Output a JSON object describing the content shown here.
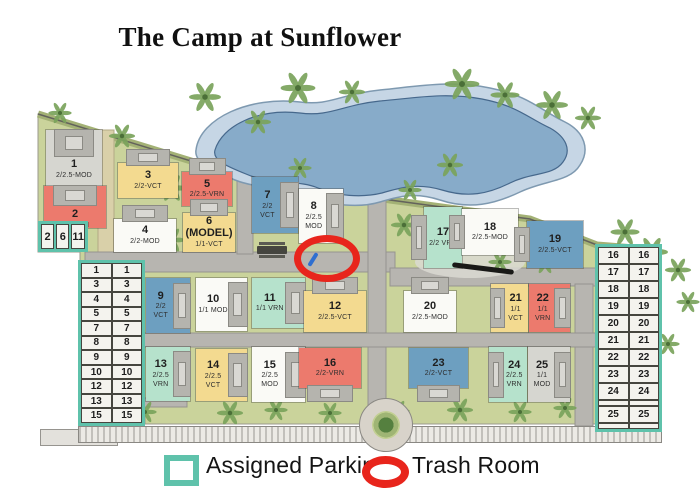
{
  "title": "The Camp at Sunflower",
  "legend": {
    "assigned_parking": "Assigned Parking",
    "trash_room": "Trash Room"
  },
  "colors": {
    "parking_teal": "#5fc2ab",
    "trash_red": "#e8251c",
    "pond": "#87abc9",
    "pond_rim": "#c6d6e5",
    "grass": "#cad39b",
    "road": "#b7b5b0",
    "building": "#b5b4ae",
    "palm": "#79a35b",
    "unit_gray": "#d6d6d0",
    "unit_red": "#ec7a6d",
    "unit_yellow": "#f3da90",
    "unit_mint": "#b6e2cc",
    "unit_blue": "#6d9fc0",
    "unit_white": "#fafaf6"
  },
  "units": [
    {
      "number": "1",
      "type": "2/2.5-MOD",
      "color": "gray"
    },
    {
      "number": "2",
      "type": "1/1-VRN",
      "color": "red"
    },
    {
      "number": "3",
      "type": "2/2-VCT",
      "color": "yellow"
    },
    {
      "number": "4",
      "type": "2/2-MOD",
      "color": "white"
    },
    {
      "number": "5",
      "type": "2/2.5-VRN",
      "color": "red"
    },
    {
      "number": "6",
      "model_tag": "(MODEL)",
      "type": "1/1-VCT",
      "color": "yellow"
    },
    {
      "number": "7",
      "type": "2/2 VCT",
      "color": "blue"
    },
    {
      "number": "8",
      "type": "2/2.5 MOD",
      "color": "white"
    },
    {
      "number": "9",
      "type": "2/2 VCT",
      "color": "blue"
    },
    {
      "number": "10",
      "type": "1/1 MOD",
      "color": "white"
    },
    {
      "number": "11",
      "type": "1/1 VRN",
      "color": "mint"
    },
    {
      "number": "12",
      "type": "2/2.5-VCT",
      "color": "yellow"
    },
    {
      "number": "13",
      "type": "2/2.5 VRN",
      "color": "mint"
    },
    {
      "number": "14",
      "type": "2/2.5 VCT",
      "color": "yellow"
    },
    {
      "number": "15",
      "type": "2/2.5 MOD",
      "color": "white"
    },
    {
      "number": "16",
      "type": "2/2-VRN",
      "color": "red"
    },
    {
      "number": "17",
      "type": "2/2 VRN",
      "color": "mint"
    },
    {
      "number": "18",
      "type": "2/2.5-MOD",
      "color": "white"
    },
    {
      "number": "19",
      "type": "2/2.5-VCT",
      "color": "blue"
    },
    {
      "number": "20",
      "type": "2/2.5-MOD",
      "color": "white"
    },
    {
      "number": "21",
      "type": "1/1 VCT",
      "color": "yellow"
    },
    {
      "number": "22",
      "type": "1/1 VRN",
      "color": "red"
    },
    {
      "number": "23",
      "type": "2/2-VCT",
      "color": "blue"
    },
    {
      "number": "24",
      "type": "2/2.5 VRN",
      "color": "mint"
    },
    {
      "number": "25",
      "type": "1/1 MOD",
      "color": "gray"
    }
  ],
  "parking": {
    "small_box": [
      "2",
      "6",
      "11"
    ],
    "left_table": [
      [
        "1",
        "1"
      ],
      [
        "3",
        "3"
      ],
      [
        "4",
        "4"
      ],
      [
        "5",
        "5"
      ],
      [
        "7",
        "7"
      ],
      [
        "8",
        "8"
      ],
      [
        "9",
        "9"
      ],
      [
        "10",
        "10"
      ],
      [
        "12",
        "12"
      ],
      [
        "13",
        "13"
      ],
      [
        "15",
        "15"
      ]
    ],
    "right_table": [
      [
        "16",
        "16"
      ],
      [
        "17",
        "17"
      ],
      [
        "18",
        "18"
      ],
      [
        "19",
        "19"
      ],
      [
        "20",
        "20"
      ],
      [
        "21",
        "21"
      ],
      [
        "22",
        "22"
      ],
      [
        "23",
        "23"
      ],
      [
        "24",
        "24"
      ],
      [
        "",
        ""
      ],
      [
        "25",
        "25"
      ],
      [
        "",
        ""
      ]
    ]
  }
}
